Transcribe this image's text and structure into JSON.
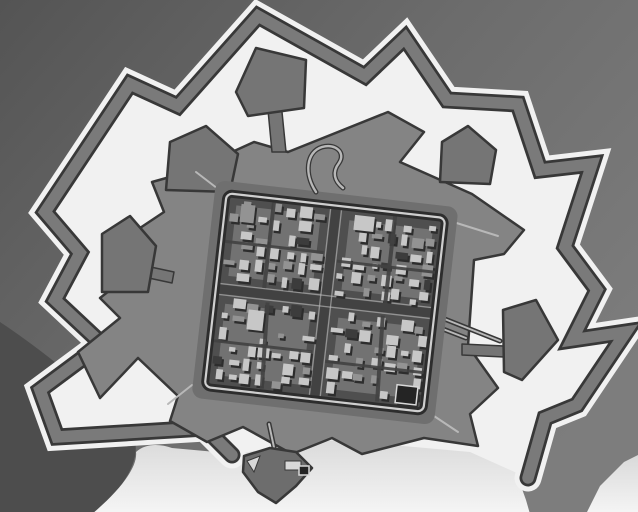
{
  "meta": {
    "description": "Black-and-white aerial photograph of a star-shaped bastion fortress town: a zig-zag outer covered way, a wide light-toned moat, detached pentagonal ravelins, an inner bastioned rampart, and a dense grid of small buildings inside a tilted square town wall. Light open ground lies along the bottom of the frame with a small detached triangular outwork."
  },
  "colors": {
    "bg1": "#545454",
    "bg2": "#6c6c6c",
    "bg3": "#7d7d7d",
    "wedge": "#4d4d4d",
    "moat": "#f1f1f1",
    "band": "#7a7a7a",
    "edge": "#383838",
    "rampart": "#848484",
    "ravelin": "#757575",
    "outwork": "#6d6d6d",
    "berm": "#6f6f6f",
    "ground": "#4f4f4f",
    "court": "#868686",
    "street": "#424242",
    "bldlight": "#c7c7c7",
    "bldmid": "#939393",
    "blddark": "#3c3c3c",
    "bldshadow": "#2d2d2d",
    "walldark": "#2d2d2d",
    "walllight": "#cfcfcf",
    "roadlight": "#b8b8b8",
    "fg1": "#d9d9d9",
    "fg2": "#f5f5f5",
    "framelight": "#d8d8d8",
    "framedark": "#242424"
  },
  "scene": {
    "paths": {
      "wedge": "M 0,322 C 45,352 95,392 134,438 C 142,460 122,490 94,514 L 0,514 Z",
      "fg_main": "M 92,514 C 118,492 138,468 136,452 C 146,443 160,444 172,448 L 238,454 L 258,448 L 336,436 L 428,448 L 466,440 L 500,452 L 516,472 L 526,500 L 530,514 Z",
      "fg_corner": "M 586,514 L 600,486 L 624,462 L 640,454 L 640,514 Z",
      "moat_fill": "M 232,455 L 205,428 L 57,437 L 40,390 L 102,344 L 55,300 L 80,253 L 45,212 L 130,84 L 178,106 L 258,16 L 365,76 L 405,38 L 447,100 L 518,104 L 540,170 L 592,164 L 565,247 L 597,290 L 572,340 L 626,332 L 577,405 L 545,418 L 528,478 L 470,452 L 336,440 L 260,450 Z",
      "covered_way": "M 232,455 L 205,428 L 57,437 L 40,390 L 102,344 L 55,300 L 80,253 L 45,212 L 130,84 L 178,106 L 258,16 L 365,76 L 405,38 L 447,100 L 518,104 L 540,170 L 592,164 L 565,247 L 597,290 L 572,340 L 626,332 L 577,405 L 545,418 L 528,478",
      "enceinte": "M 188,172 L 254,142 L 288,152 L 388,112 L 424,132 L 400,162 L 472,194 L 524,230 L 504,254 L 474,260 L 468,346 L 498,388 L 470,414 L 478,446 L 424,438 L 362,454 L 332,438 L 292,454 L 243,427 L 207,442 L 170,421 L 178,396 L 138,358 L 100,398 L 78,352 L 120,318 L 100,298 L 146,262 L 134,232 L 164,212 L 152,182 Z",
      "gate_loop": "M 316,192 C 304,174 306,152 322,147 C 336,143 346,153 339,163 C 332,172 334,181 343,188"
    },
    "ravelins": [
      {
        "name": "ravelin-north",
        "d": "M 236,92 L 256,48 L 306,60 L 304,108 L 248,116 Z"
      },
      {
        "name": "ravelin-north-west",
        "d": "M 166,190 L 170,142 L 206,126 L 238,154 L 230,192 Z"
      },
      {
        "name": "ravelin-north-east",
        "d": "M 440,182 L 442,142 L 468,126 L 496,150 L 490,184 Z"
      },
      {
        "name": "ravelin-east",
        "d": "M 503,310 L 536,300 L 558,340 L 522,380 L 504,372 Z"
      },
      {
        "name": "ravelin-west",
        "d": "M 102,292 L 102,234 L 130,216 L 156,246 L 148,292 Z"
      }
    ],
    "stems": [
      {
        "name": "causeway-north",
        "d": "M 268,110 L 282,112 L 286,152 L 272,152 Z"
      },
      {
        "name": "causeway-north-west",
        "d": "M 220,188 L 236,194 L 231,214 L 216,208 Z"
      },
      {
        "name": "causeway-east",
        "d": "M 462,344 L 504,346 L 504,357 L 462,355 Z"
      },
      {
        "name": "causeway-west",
        "d": "M 146,266 L 174,272 L 172,283 L 144,277 Z"
      }
    ],
    "outwork": {
      "body": "M 244,456 L 270,448 L 296,452 L 312,468 L 296,486 L 276,503 L 258,492 L 243,472 Z",
      "notch": "M 247,461 L 260,456 L 254,472 Z",
      "light_rect": {
        "x": 285,
        "y": 461,
        "w": 16,
        "h": 9
      },
      "dark_rect": {
        "x": 299,
        "y": 466,
        "w": 10,
        "h": 9
      }
    },
    "bridges": [
      {
        "name": "bridge-south",
        "x1": 269,
        "y1": 424,
        "x2": 275,
        "y2": 452
      },
      {
        "name": "causeway-east-road",
        "x1": 432,
        "y1": 314,
        "x2": 500,
        "y2": 341
      },
      {
        "name": "causeway-east-road-2",
        "x1": 430,
        "y1": 324,
        "x2": 466,
        "y2": 338
      }
    ],
    "roads": [
      {
        "name": "rampart-road-nw",
        "x1": 222,
        "y1": 192,
        "x2": 196,
        "y2": 172
      },
      {
        "name": "rampart-road-ne",
        "x1": 447,
        "y1": 220,
        "x2": 498,
        "y2": 236
      },
      {
        "name": "rampart-road-se",
        "x1": 428,
        "y1": 412,
        "x2": 458,
        "y2": 432
      },
      {
        "name": "rampart-road-sw",
        "x1": 192,
        "y1": 385,
        "x2": 168,
        "y2": 404
      }
    ],
    "town": {
      "transform": "rotate(6.5 325 302)",
      "berm": {
        "x": 203,
        "y": 193,
        "w": 244,
        "h": 219,
        "rx": 10
      },
      "ground": {
        "x": 213,
        "y": 203,
        "w": 224,
        "h": 199,
        "rx": 8
      },
      "wall": {
        "x": 215,
        "y": 205,
        "w": 220,
        "h": 195,
        "rx": 6
      },
      "streets": [
        {
          "x1": 325.5,
          "y1": 207,
          "x2": 325.5,
          "y2": 399,
          "w": 9
        },
        {
          "x1": 216,
          "y1": 301,
          "x2": 434,
          "y2": 301,
          "w": 9
        }
      ],
      "edges": [
        {
          "x1": 320,
          "y1": 208,
          "x2": 320,
          "y2": 398,
          "w": 1.3
        },
        {
          "x1": 331,
          "y1": 208,
          "x2": 331,
          "y2": 398,
          "w": 1.3
        },
        {
          "x1": 217,
          "y1": 295.5,
          "x2": 433,
          "y2": 295.5,
          "w": 1.3
        },
        {
          "x1": 217,
          "y1": 306.5,
          "x2": 433,
          "y2": 306.5,
          "w": 1.3
        }
      ],
      "lanes": [
        {
          "x1": 263,
          "y1": 209,
          "x2": 263,
          "y2": 295,
          "w": 4
        },
        {
          "x1": 385,
          "y1": 209,
          "x2": 385,
          "y2": 297,
          "w": 4
        },
        {
          "x1": 268,
          "y1": 309,
          "x2": 272,
          "y2": 395,
          "w": 4
        },
        {
          "x1": 384,
          "y1": 309,
          "x2": 388,
          "y2": 395,
          "w": 4
        },
        {
          "x1": 218,
          "y1": 253,
          "x2": 318,
          "y2": 253,
          "w": 3
        },
        {
          "x1": 332,
          "y1": 260,
          "x2": 432,
          "y2": 260,
          "w": 3
        },
        {
          "x1": 218,
          "y1": 353,
          "x2": 318,
          "y2": 353,
          "w": 3
        },
        {
          "x1": 332,
          "y1": 361,
          "x2": 432,
          "y2": 361,
          "w": 3
        }
      ],
      "blocks": [
        {
          "name": "district-nw",
          "x": 219,
          "y": 209,
          "w": 99,
          "h": 85,
          "cols": 7,
          "rows": 6,
          "seed": 11
        },
        {
          "name": "district-ne",
          "x": 333,
          "y": 211,
          "w": 98,
          "h": 84,
          "cols": 7,
          "rows": 6,
          "seed": 23
        },
        {
          "name": "district-sw",
          "x": 219,
          "y": 308,
          "w": 100,
          "h": 86,
          "cols": 7,
          "rows": 6,
          "seed": 37
        },
        {
          "name": "district-se",
          "x": 333,
          "y": 309,
          "w": 98,
          "h": 86,
          "cols": 7,
          "rows": 6,
          "seed": 53
        }
      ],
      "landmarks": [
        {
          "name": "landmark-se-court",
          "x": 406,
          "y": 376,
          "w": 21,
          "h": 18,
          "tone": "dark",
          "frame": true
        },
        {
          "name": "landmark-ne-hall",
          "x": 345,
          "y": 212,
          "w": 20,
          "h": 15,
          "tone": "light"
        },
        {
          "name": "landmark-sw-hall",
          "x": 250,
          "y": 318,
          "w": 16,
          "h": 20,
          "tone": "light"
        },
        {
          "name": "landmark-nw-hall",
          "x": 231,
          "y": 214,
          "w": 14,
          "h": 18,
          "tone": "mid"
        }
      ]
    }
  }
}
